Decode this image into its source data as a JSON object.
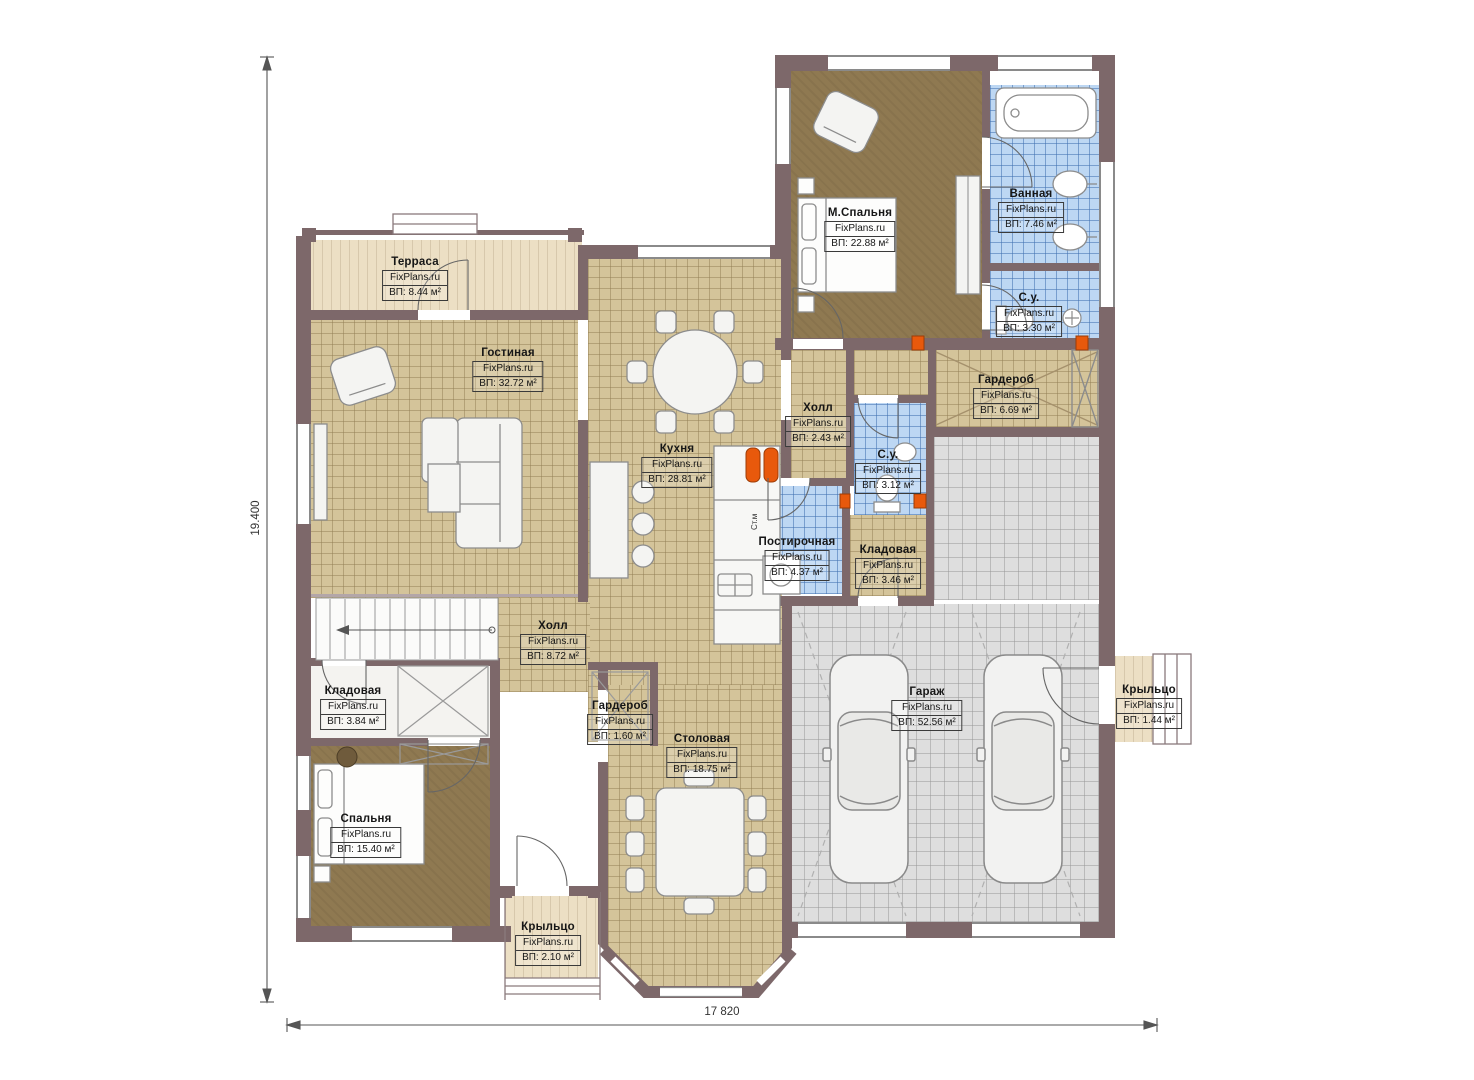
{
  "meta": {
    "brand": "FixPlans.ru"
  },
  "dims": {
    "v": "19.400",
    "h": "17 820"
  },
  "rooms": [
    {
      "name": "Терраса",
      "area": "ВП: 8.44 м²"
    },
    {
      "name": "Гостиная",
      "area": "ВП: 32.72 м²"
    },
    {
      "name": "Кухня",
      "area": "ВП: 28.81 м²"
    },
    {
      "name": "М.Спальня",
      "area": "ВП: 22.88 м²"
    },
    {
      "name": "Ванная",
      "area": "ВП: 7.46 м²"
    },
    {
      "name": "С.у.",
      "area": "ВП: 3.30 м²"
    },
    {
      "name": "Гардероб",
      "area": "ВП: 6.69 м²"
    },
    {
      "name": "Холл",
      "area": "ВП: 2.43 м²"
    },
    {
      "name": "С.у.",
      "area": "ВП: 3.12 м²"
    },
    {
      "name": "Постирочная",
      "area": "ВП: 4.37 м²"
    },
    {
      "name": "Кладовая",
      "area": "ВП: 3.46 м²"
    },
    {
      "name": "Холл",
      "area": "ВП: 8.72 м²"
    },
    {
      "name": "Гардероб",
      "area": "ВП: 1.60 м²"
    },
    {
      "name": "Столовая",
      "area": "ВП: 18.75 м²"
    },
    {
      "name": "Кладовая",
      "area": "ВП: 3.84 м²"
    },
    {
      "name": "Спальня",
      "area": "ВП: 15.40 м²"
    },
    {
      "name": "Крыльцо",
      "area": "ВП: 2.10 м²"
    },
    {
      "name": "Гараж",
      "area": "ВП: 52.56 м²"
    },
    {
      "name": "Крыльцо",
      "area": "ВП: 1.44 м²"
    }
  ],
  "annotations": {
    "washer": "Ст.м"
  },
  "colors": {
    "wall": "#7d686a",
    "floor_tan": "#d4c49a",
    "carpet": "#8f7951",
    "tile_blue": "#bdd7f3",
    "garage_gray": "#dedede",
    "outdoor_beige": "#ecdfc4",
    "accent_orange": "#e8590c"
  }
}
